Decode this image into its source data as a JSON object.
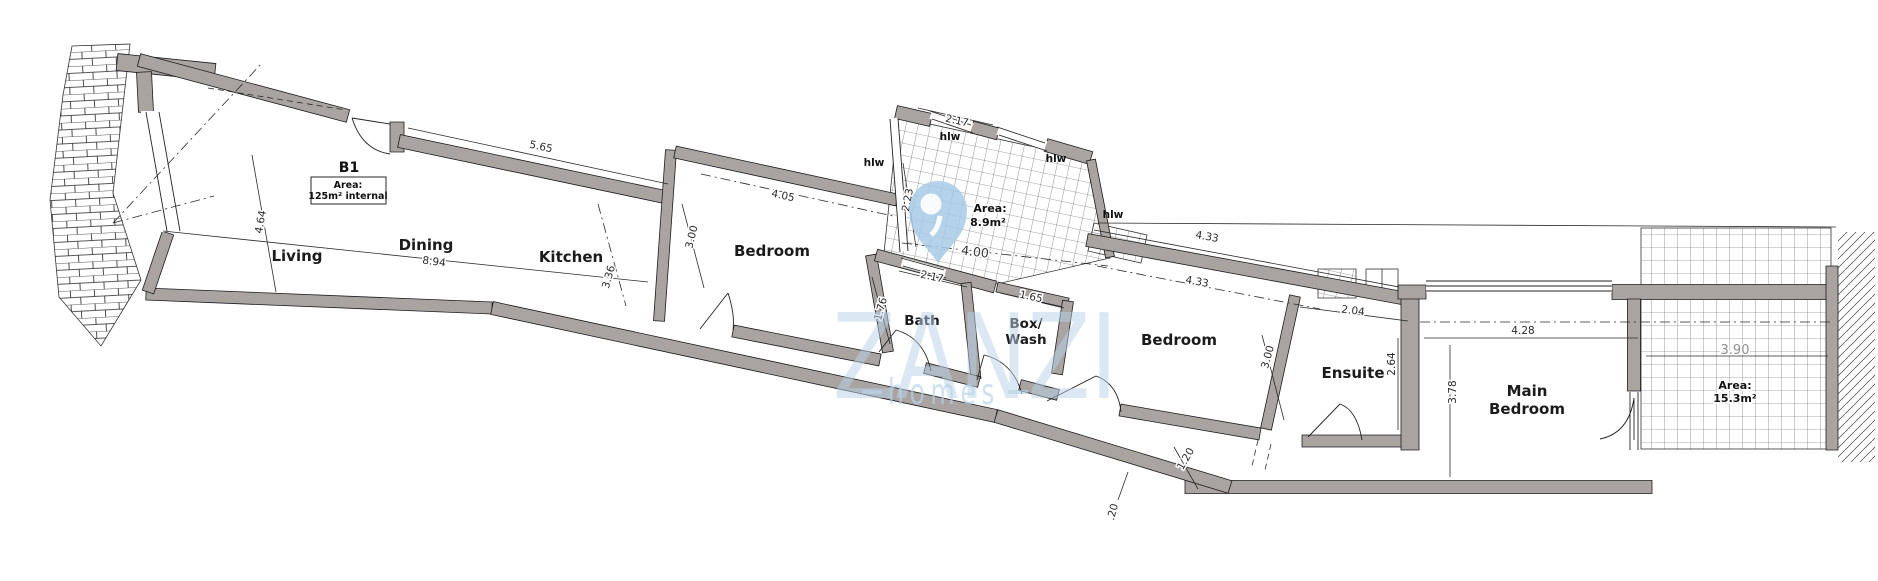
{
  "plan": {
    "unit_label": "B1",
    "unit_area": {
      "line1": "Area:",
      "line2": "125m² internal"
    },
    "rooms": {
      "living": "Living",
      "dining": "Dining",
      "kitchen": "Kitchen",
      "bedroom1": "Bedroom",
      "bath": "Bath",
      "box_wash_line1": "Box/",
      "box_wash_line2": "Wash",
      "bedroom2": "Bedroom",
      "ensuite": "Ensuite",
      "main_bedroom_line1": "Main",
      "main_bedroom_line2": "Bedroom"
    },
    "areas": {
      "shaft": {
        "line1": "Area:",
        "line2": "8.9m²"
      },
      "terrace": {
        "line1": "Area:",
        "line2": "15.3m²"
      }
    },
    "window_labels": {
      "w1": "hlw",
      "w2": "hlw",
      "w3": "hlw",
      "w4": "hlw"
    },
    "dimensions": {
      "d565": "5.65",
      "d894": "8.94",
      "d464": "4.64",
      "d336": "3.36",
      "d405": "4.05",
      "d300a": "3.00",
      "d217a": "2.17",
      "d223": "2.23",
      "d400": "4.00",
      "d217b": "2.17",
      "d176": "1.76",
      "d165": "1.65",
      "d433a": "4.33",
      "d433b": "4.33",
      "d300b": "3.00",
      "d204": "2.04",
      "d264": "2.64",
      "d428": "4.28",
      "d378": "3.78",
      "d390": "3.90",
      "d120": "1.20",
      "d020": ".20"
    },
    "watermark": {
      "brand": "ZANZI",
      "tagline": "homes",
      "color": "#b9d3e9"
    },
    "colors": {
      "wall_fill": "#a9a4a1",
      "line": "#1c1c1c"
    }
  }
}
